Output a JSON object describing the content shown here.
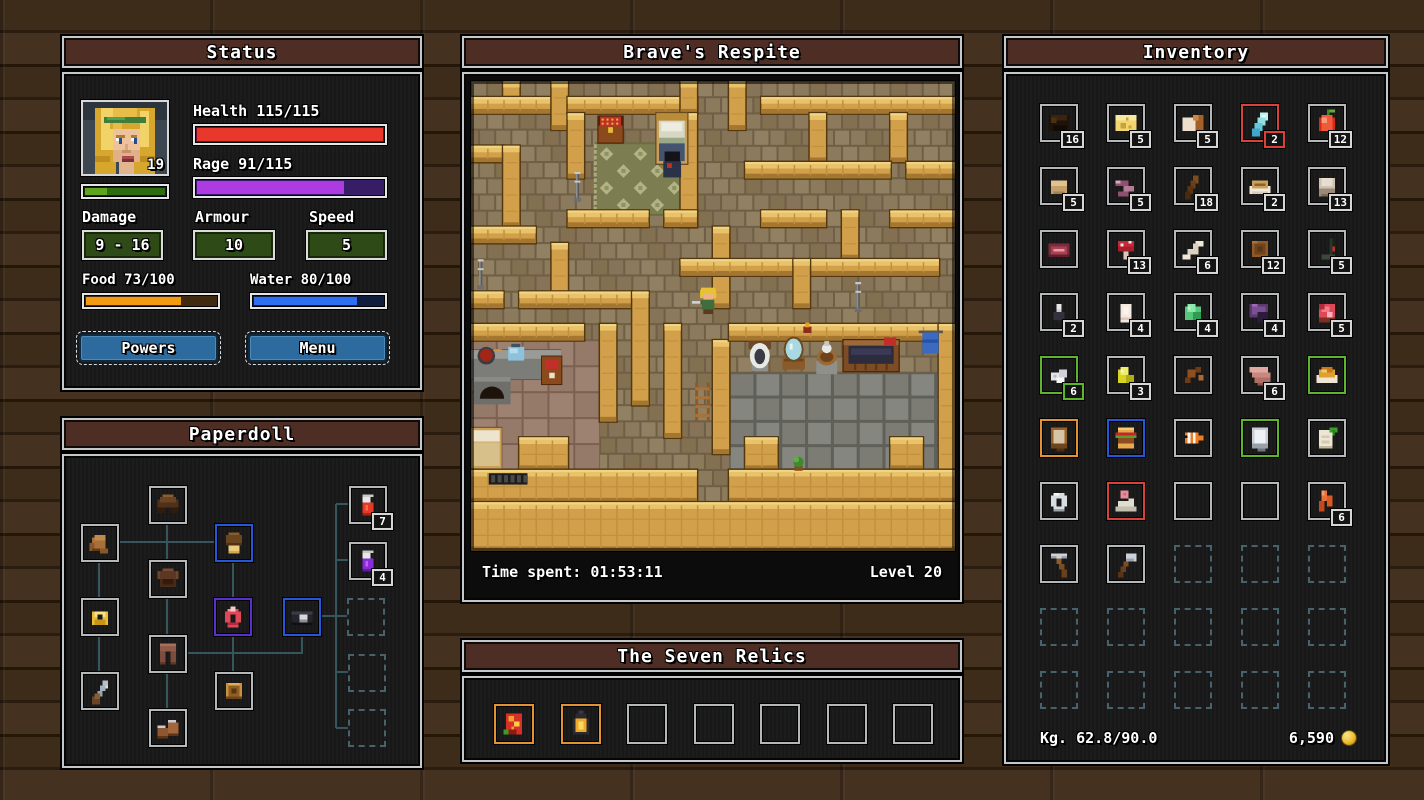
{
  "status": {
    "title": "Status",
    "portrait_level": "19",
    "health_label": "Health 115/115",
    "health_pct": 100,
    "rage_label": "Rage 91/115",
    "rage_pct": 79,
    "xp_pct": 28,
    "damage_label": "Damage",
    "damage_value": "9 - 16",
    "armour_label": "Armour",
    "armour_value": "10",
    "speed_label": "Speed",
    "speed_value": "5",
    "food_label": "Food 73/100",
    "food_pct": 73,
    "water_label": "Water 80/100",
    "water_pct": 80,
    "powers_label": "Powers",
    "menu_label": "Menu",
    "colors": {
      "health": "#e8382c",
      "health_track": "#6a1030",
      "rage": "#ae3be2",
      "rage_track": "#371d66",
      "xp_bright": "#5da51c",
      "xp_dark": "#2f6b10",
      "food": "#f29a12",
      "food_track": "#3f2a10",
      "water": "#2e6ef0",
      "water_track": "#101c3c"
    }
  },
  "paperdoll": {
    "title": "Paperdoll",
    "slots": [
      {
        "name": "shoulders",
        "icon": "pauldrons",
        "x": 85,
        "y": 30,
        "border": ""
      },
      {
        "name": "gloves",
        "icon": "gloves",
        "x": 17,
        "y": 68,
        "border": ""
      },
      {
        "name": "helmet",
        "icon": "cap",
        "x": 151,
        "y": 68,
        "border": "b-blue"
      },
      {
        "name": "chest",
        "icon": "chestplate",
        "x": 85,
        "y": 104,
        "border": ""
      },
      {
        "name": "ring",
        "icon": "ring-gold",
        "x": 17,
        "y": 142,
        "border": ""
      },
      {
        "name": "amulet",
        "icon": "amulet",
        "x": 150,
        "y": 142,
        "border": "b-purple"
      },
      {
        "name": "belt",
        "icon": "belt",
        "x": 219,
        "y": 142,
        "border": "b-blue"
      },
      {
        "name": "legs",
        "icon": "legs",
        "x": 85,
        "y": 179,
        "border": ""
      },
      {
        "name": "weapon",
        "icon": "sword",
        "x": 17,
        "y": 216,
        "border": ""
      },
      {
        "name": "shield",
        "icon": "shield",
        "x": 151,
        "y": 216,
        "border": ""
      },
      {
        "name": "boots",
        "icon": "boots",
        "x": 85,
        "y": 253,
        "border": ""
      },
      {
        "name": "quick-potion-1",
        "icon": "potion-red",
        "x": 285,
        "y": 30,
        "border": "",
        "qty": "7"
      },
      {
        "name": "quick-potion-2",
        "icon": "potion-purple",
        "x": 285,
        "y": 86,
        "border": "",
        "qty": "4"
      },
      {
        "name": "quick-empty-1",
        "icon": "",
        "x": 283,
        "y": 142,
        "border": "locked"
      },
      {
        "name": "quick-empty-2",
        "icon": "",
        "x": 284,
        "y": 198,
        "border": "locked"
      },
      {
        "name": "quick-empty-3",
        "icon": "",
        "x": 284,
        "y": 253,
        "border": "locked"
      }
    ],
    "lines": [
      [
        55,
        86,
        151,
        86
      ],
      [
        103,
        68,
        103,
        104
      ],
      [
        35,
        106,
        35,
        142
      ],
      [
        35,
        180,
        35,
        216
      ],
      [
        169,
        106,
        169,
        142
      ],
      [
        103,
        142,
        103,
        179
      ],
      [
        103,
        217,
        103,
        253
      ],
      [
        169,
        180,
        169,
        216
      ],
      [
        123,
        197,
        239,
        197
      ],
      [
        238,
        180,
        238,
        197
      ],
      [
        257,
        160,
        272,
        160
      ],
      [
        272,
        48,
        272,
        272
      ],
      [
        272,
        48,
        285,
        48
      ],
      [
        272,
        104,
        285,
        104
      ],
      [
        272,
        160,
        283,
        160
      ],
      [
        272,
        216,
        284,
        216
      ],
      [
        272,
        272,
        284,
        272
      ]
    ]
  },
  "map": {
    "title": "Brave's Respite",
    "time_label": "Time spent: 01:53:11",
    "level_label": "Level 20",
    "walls": [
      [
        2,
        0,
        1,
        2
      ],
      [
        0,
        1,
        5,
        1
      ],
      [
        5,
        0,
        1,
        3
      ],
      [
        6,
        1,
        8,
        1
      ],
      [
        13,
        0,
        1,
        2
      ],
      [
        16,
        0,
        1,
        3
      ],
      [
        18,
        1,
        12,
        1
      ],
      [
        21,
        2,
        1,
        3
      ],
      [
        26,
        2,
        1,
        3
      ],
      [
        6,
        2,
        1,
        4
      ],
      [
        13,
        2,
        1,
        7
      ],
      [
        0,
        4,
        2,
        1
      ],
      [
        2,
        4,
        1,
        5
      ],
      [
        17,
        5,
        9,
        1
      ],
      [
        27,
        5,
        3,
        1
      ],
      [
        6,
        8,
        5,
        1
      ],
      [
        12,
        8,
        2,
        1
      ],
      [
        0,
        9,
        4,
        1
      ],
      [
        15,
        9,
        1,
        5
      ],
      [
        18,
        8,
        4,
        1
      ],
      [
        23,
        8,
        1,
        3
      ],
      [
        26,
        8,
        4,
        1
      ],
      [
        5,
        10,
        1,
        4
      ],
      [
        13,
        11,
        7,
        1
      ],
      [
        21,
        11,
        8,
        1
      ],
      [
        20,
        11,
        1,
        3
      ],
      [
        0,
        13,
        2,
        1
      ],
      [
        3,
        13,
        7,
        1
      ],
      [
        10,
        13,
        1,
        7
      ],
      [
        0,
        15,
        7,
        1
      ],
      [
        8,
        15,
        1,
        6
      ],
      [
        12,
        15,
        1,
        7
      ],
      [
        15,
        16,
        1,
        7
      ],
      [
        16,
        15,
        13,
        1
      ],
      [
        29,
        15,
        1,
        11
      ],
      [
        3,
        22,
        3,
        2
      ],
      [
        17,
        22,
        2,
        2
      ],
      [
        26,
        22,
        2,
        2
      ],
      [
        0,
        24,
        14,
        2
      ],
      [
        16,
        24,
        14,
        2
      ],
      [
        0,
        26,
        30,
        3
      ]
    ],
    "regions": [
      {
        "type": "pink",
        "x": 0,
        "y": 16,
        "w": 8,
        "h": 8
      },
      {
        "type": "gray",
        "x": 16,
        "y": 18,
        "w": 13,
        "h": 6
      },
      {
        "type": "rug",
        "x": 7.8,
        "y": 3.9,
        "w": 5.4,
        "h": 4.3
      }
    ],
    "entities": [
      {
        "type": "chest",
        "x": 7.9,
        "y": 2.2
      },
      {
        "type": "bed",
        "x": 11.5,
        "y": 2.0
      },
      {
        "type": "npc",
        "x": 12.0,
        "y": 4.35
      },
      {
        "type": "player",
        "x": 14.2,
        "y": 12.8
      },
      {
        "type": "candle",
        "x": 0.5,
        "y": 11.0
      },
      {
        "type": "candle",
        "x": 6.5,
        "y": 5.6
      },
      {
        "type": "candle",
        "x": 23.9,
        "y": 12.4
      },
      {
        "type": "kitchen",
        "x": 0,
        "y": 16.5
      },
      {
        "type": "sign",
        "x": 4.4,
        "y": 17.0
      },
      {
        "type": "guestbed",
        "x": 0.0,
        "y": 21.4
      },
      {
        "type": "grate",
        "x": 1.1,
        "y": 24.2
      },
      {
        "type": "toilet",
        "x": 17.2,
        "y": 16.1
      },
      {
        "type": "mirror",
        "x": 19.3,
        "y": 16.0
      },
      {
        "type": "basin",
        "x": 21.4,
        "y": 16.3
      },
      {
        "type": "tub",
        "x": 23.1,
        "y": 16.0
      },
      {
        "type": "towel",
        "x": 27.9,
        "y": 15.4
      },
      {
        "type": "sconce",
        "x": 20.6,
        "y": 15.15
      },
      {
        "type": "ladder",
        "x": 13.9,
        "y": 18.6
      },
      {
        "type": "plant",
        "x": 19.9,
        "y": 23.2
      }
    ]
  },
  "relics": {
    "title": "The Seven Relics",
    "slots": [
      {
        "name": "relic-tapestry",
        "icon": "relic-cloth",
        "border": "b-orange"
      },
      {
        "name": "relic-lantern",
        "icon": "relic-lantern",
        "border": "b-orange"
      },
      {
        "name": "relic-empty-3",
        "icon": "",
        "border": ""
      },
      {
        "name": "relic-empty-4",
        "icon": "",
        "border": ""
      },
      {
        "name": "relic-empty-5",
        "icon": "",
        "border": ""
      },
      {
        "name": "relic-empty-6",
        "icon": "",
        "border": ""
      },
      {
        "name": "relic-empty-7",
        "icon": "",
        "border": ""
      }
    ]
  },
  "inventory": {
    "title": "Inventory",
    "weight_label": "Kg. 62.8/90.0",
    "gold": "6,590",
    "items": [
      {
        "icon": "hide",
        "qty": "16",
        "border": ""
      },
      {
        "icon": "cheese",
        "qty": "5",
        "border": ""
      },
      {
        "icon": "bread",
        "qty": "5",
        "border": ""
      },
      {
        "icon": "crystal-blue",
        "qty": "2",
        "border": "b-red"
      },
      {
        "icon": "apple",
        "qty": "12",
        "border": ""
      },
      {
        "icon": "hay",
        "qty": "5",
        "border": ""
      },
      {
        "icon": "worms",
        "qty": "5",
        "border": ""
      },
      {
        "icon": "stick",
        "qty": "18",
        "border": ""
      },
      {
        "icon": "bowl",
        "qty": "2",
        "border": ""
      },
      {
        "icon": "wool",
        "qty": "13",
        "border": ""
      },
      {
        "icon": "steak",
        "qty": "",
        "border": ""
      },
      {
        "icon": "mushroom",
        "qty": "13",
        "border": ""
      },
      {
        "icon": "bone",
        "qty": "6",
        "border": ""
      },
      {
        "icon": "pelt",
        "qty": "12",
        "border": ""
      },
      {
        "icon": "darkbow",
        "qty": "5",
        "border": ""
      },
      {
        "icon": "figurine",
        "qty": "2",
        "border": ""
      },
      {
        "icon": "egg",
        "qty": "4",
        "border": ""
      },
      {
        "icon": "slime",
        "qty": "4",
        "border": ""
      },
      {
        "icon": "batwing",
        "qty": "4",
        "border": ""
      },
      {
        "icon": "redmeat",
        "qty": "5",
        "border": ""
      },
      {
        "icon": "sugar",
        "qty": "6",
        "border": "b-green"
      },
      {
        "icon": "crystal-yellow",
        "qty": "3",
        "border": ""
      },
      {
        "icon": "bits",
        "qty": "",
        "border": ""
      },
      {
        "icon": "planks",
        "qty": "6",
        "border": ""
      },
      {
        "icon": "meal",
        "qty": "",
        "border": "b-green"
      },
      {
        "icon": "tome",
        "qty": "",
        "border": "b-orange"
      },
      {
        "icon": "burger",
        "qty": "",
        "border": "b-blue"
      },
      {
        "icon": "fish",
        "qty": "",
        "border": ""
      },
      {
        "icon": "whitebook",
        "qty": "",
        "border": "b-green"
      },
      {
        "icon": "scroll",
        "qty": "",
        "border": ""
      },
      {
        "icon": "ring-silver",
        "qty": "",
        "border": ""
      },
      {
        "icon": "bonepile",
        "qty": "",
        "border": "b-red"
      },
      {
        "icon": "",
        "qty": "",
        "border": ""
      },
      {
        "icon": "",
        "qty": "",
        "border": ""
      },
      {
        "icon": "fletching",
        "qty": "6",
        "border": ""
      },
      {
        "icon": "pickaxe",
        "qty": "",
        "border": ""
      },
      {
        "icon": "axe",
        "qty": "",
        "border": ""
      },
      {
        "icon": "",
        "qty": "",
        "border": "locked"
      },
      {
        "icon": "",
        "qty": "",
        "border": "locked"
      },
      {
        "icon": "",
        "qty": "",
        "border": "locked"
      },
      {
        "icon": "",
        "qty": "",
        "border": "locked"
      },
      {
        "icon": "",
        "qty": "",
        "border": "locked"
      },
      {
        "icon": "",
        "qty": "",
        "border": "locked"
      },
      {
        "icon": "",
        "qty": "",
        "border": "locked"
      },
      {
        "icon": "",
        "qty": "",
        "border": "locked"
      },
      {
        "icon": "",
        "qty": "",
        "border": "locked"
      },
      {
        "icon": "",
        "qty": "",
        "border": "locked"
      },
      {
        "icon": "",
        "qty": "",
        "border": "locked"
      },
      {
        "icon": "",
        "qty": "",
        "border": "locked"
      },
      {
        "icon": "",
        "qty": "",
        "border": "locked"
      }
    ]
  }
}
